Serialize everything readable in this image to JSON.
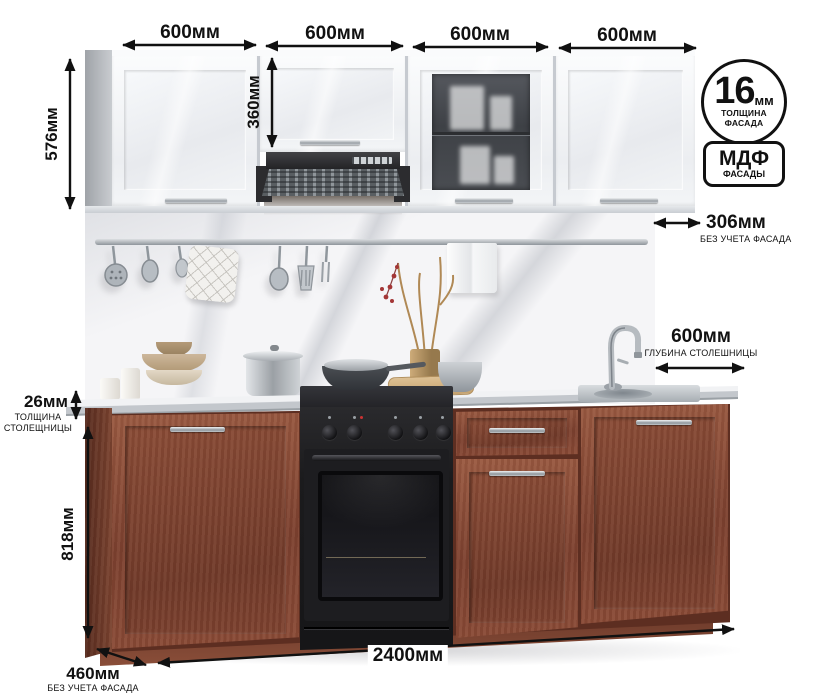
{
  "dimensions": {
    "top_widths": [
      "600мм",
      "600мм",
      "600мм",
      "600мм"
    ],
    "upper_height": {
      "value": "576мм"
    },
    "upper_door_height": {
      "value": "360мм"
    },
    "upper_depth": {
      "value": "306мм",
      "note": "БЕЗ УЧЕТА ФАСАДА"
    },
    "counter_depth": {
      "value": "600мм",
      "note": "ГЛУБИНА СТОЛЕШНИЦЫ"
    },
    "counter_thickness": {
      "value": "26мм",
      "note1": "ТОЛЩИНА",
      "note2": "СТОЛЕЩНИЦЫ"
    },
    "base_height": {
      "value": "818мм"
    },
    "base_depth": {
      "value": "460мм",
      "note": "БЕЗ УЧЕТА ФАСАДА"
    },
    "total_width": {
      "value": "2400мм"
    }
  },
  "badges": {
    "facade_thickness": {
      "number": "16",
      "unit": "мм",
      "caption1": "ТОЛЩИНА",
      "caption2": "ФАСАДА"
    },
    "material": {
      "name": "МДФ",
      "caption": "ФАСАДЫ"
    }
  },
  "colors": {
    "annotation": "#111111",
    "wood": "#8a4b37",
    "wood_dark": "#5f2d20",
    "upper_cabinet": "#f2f4f6",
    "hood": "#2e2e31",
    "marble": "#f5f5f7",
    "counter_edge": "#c3c7cc",
    "stove": "#1b1b1d",
    "steel": "#aab0b6"
  }
}
